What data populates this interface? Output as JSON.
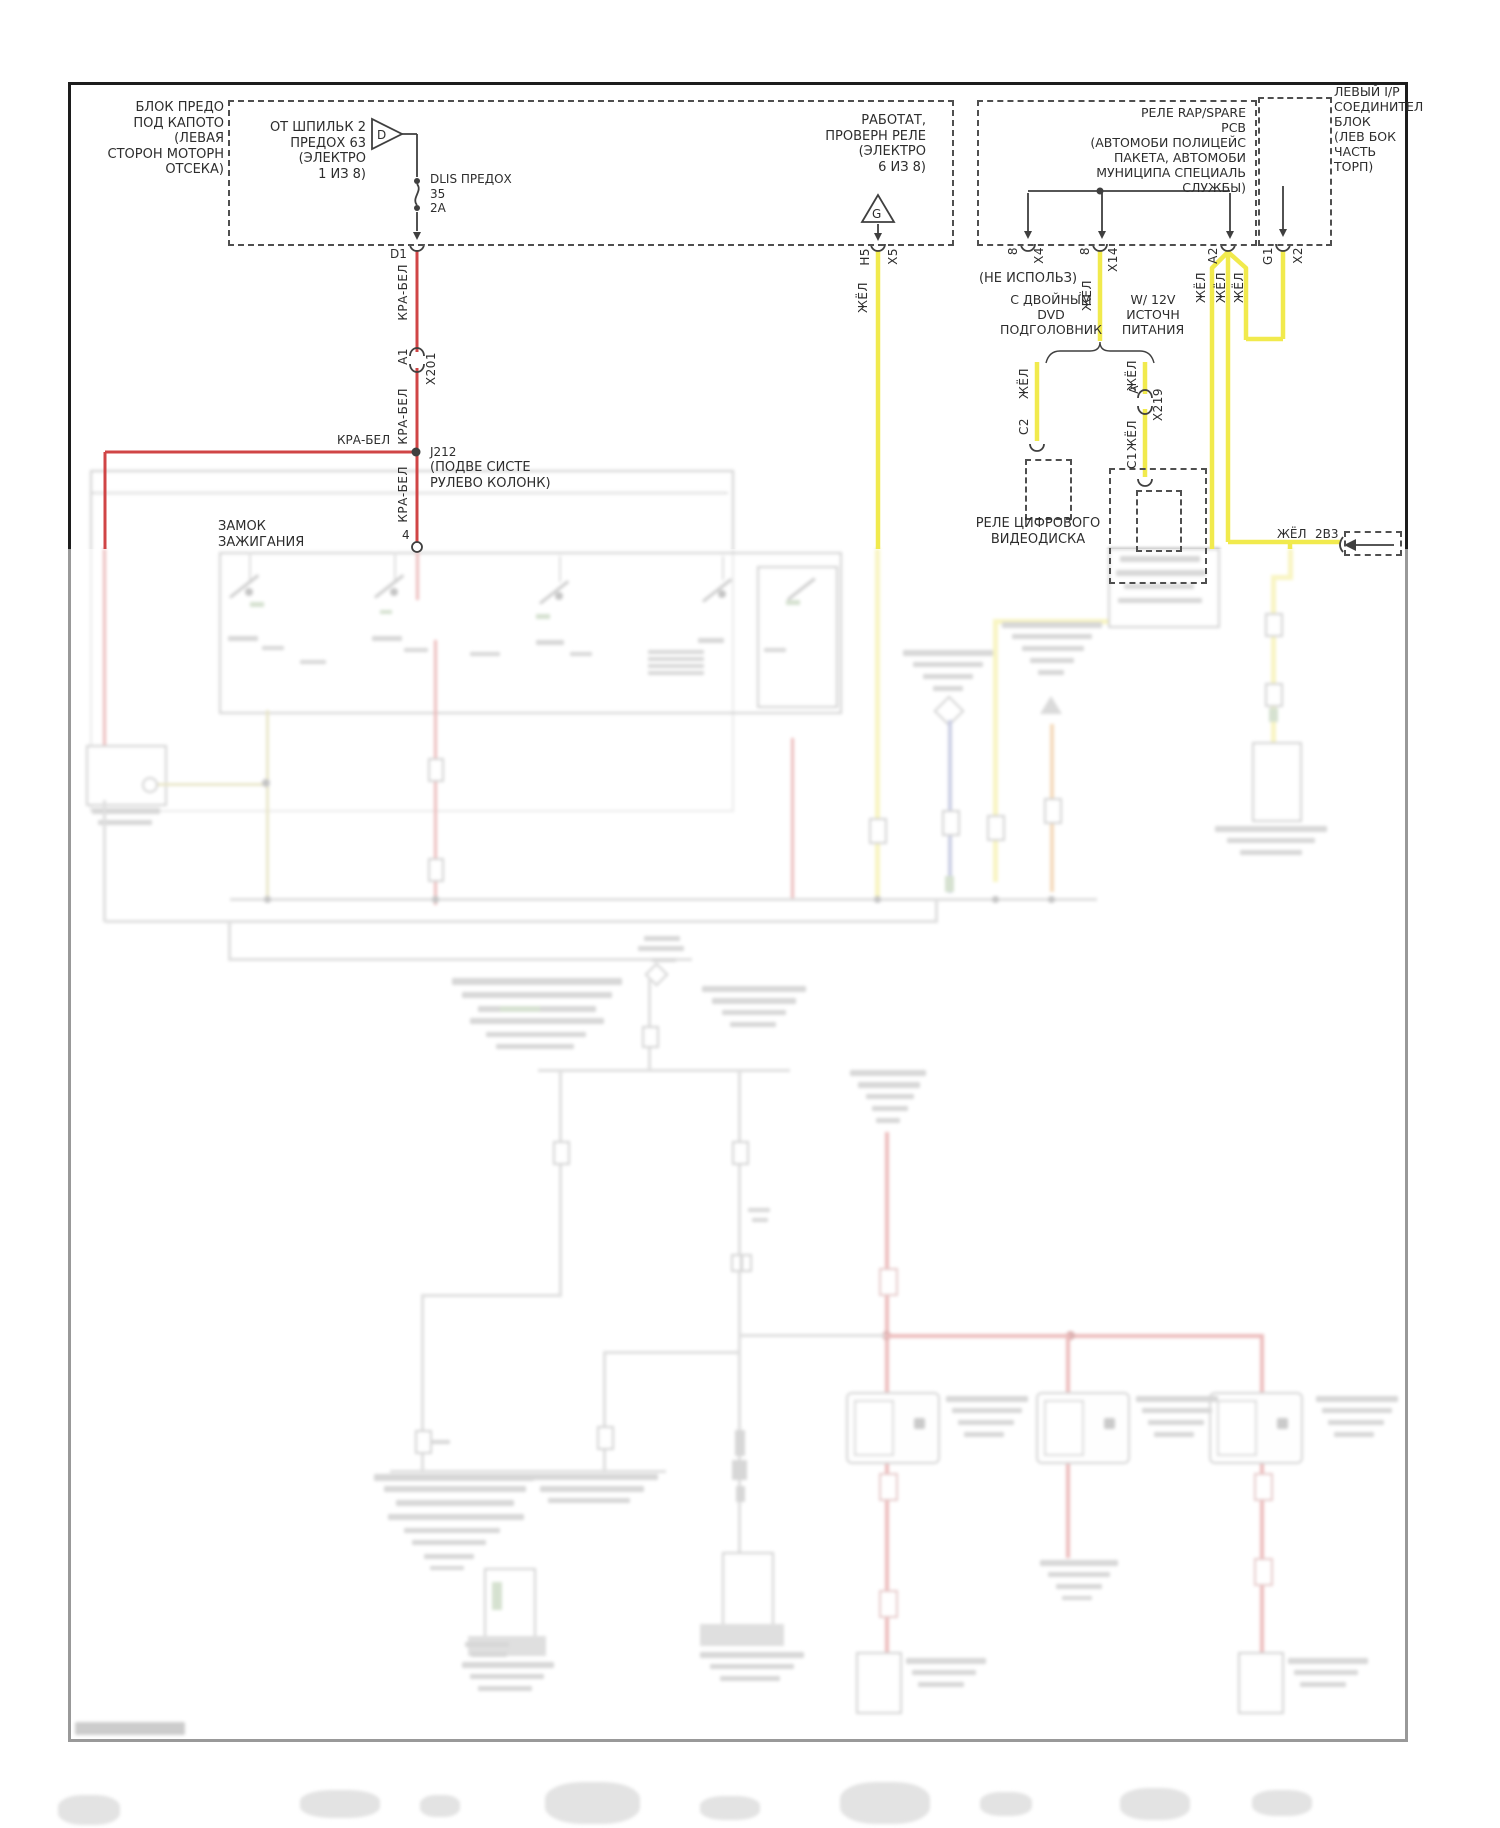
{
  "diagram": {
    "fuse_block_label": "БЛОК ПРЕДО\nПОД КАПОТО (ЛЕВАЯ\nСТОРОН МОТОРН\nОТСЕКА)",
    "fuse_feed": {
      "label": "ОТ ШПИЛЬК 2\nПРЕДОХ 63 (ЭЛЕКТРО\n1 ИЗ 8)",
      "symbol": "D"
    },
    "fuse": {
      "name": "DLIS ПРЕДОХ",
      "row": "35",
      "amps": "2А"
    },
    "pin_d1": "D1",
    "wire_red": "КРА-БЕЛ",
    "wire_yellow": "ЖЁЛ",
    "splice_x201": {
      "pin": "A1",
      "id": "X201"
    },
    "junction": {
      "id": "J212",
      "desc": "(ПОДВЕ СИСТЕ\nРУЛЕВО КОЛОНК)"
    },
    "pin_4": "4",
    "ignition_switch_label": "ЗАМОК\nЗАЖИГАНИЯ",
    "relay_test": {
      "label": "РАБОТАТ,\nПРОВЕРН РЕЛЕ\n(ЭЛЕКТРО\n6 ИЗ 8)",
      "symbol": "G",
      "pin": "H5",
      "conn": "X5"
    },
    "rap_box_label": "РЕЛЕ RAP/SPARE\nРСВ\n(АВТОМОБИ ПОЛИЦЕЙС\nПАКЕТА, АВТОМОБИ\nМУНИЦИПА СПЕЦИАЛЬ\nСЛУЖБЫ)",
    "ip_box_label": "ЛЕВЫЙ I/P\nСОЕДИНИТЕЛ\nБЛОК\n(ЛЕВ БОК\nЧАСТЬ ТОРП)",
    "conn_x4": {
      "pin": "8",
      "id": "X4",
      "note": "(НЕ ИСПОЛЬЗ)"
    },
    "conn_x14": {
      "pin": "8",
      "id": "X14"
    },
    "pin_a2": "A2",
    "conn_x2": {
      "pin": "G1",
      "id": "X2"
    },
    "option_left": "С ДВОЙНЫМ\nDVD ПОДГОЛОВНИК",
    "option_right": "W/ 12V\nИСТОЧН\nПИТАНИЯ",
    "conn_x219": {
      "pin": "A",
      "id": "X219"
    },
    "pin_c2": "C2",
    "pin_c1": "C1",
    "dvd_relay_label": "РЕЛЕ ЦИФРОВОГО\nВИДЕОДИСКА",
    "edge_wire": {
      "color": "ЖЁЛ",
      "pin": "2В3"
    },
    "colors": {
      "wire_red": "#d04546",
      "wire_yellow": "#f1ea4d",
      "dash": "#4f4f4f",
      "line": "#3f3f3f"
    }
  }
}
